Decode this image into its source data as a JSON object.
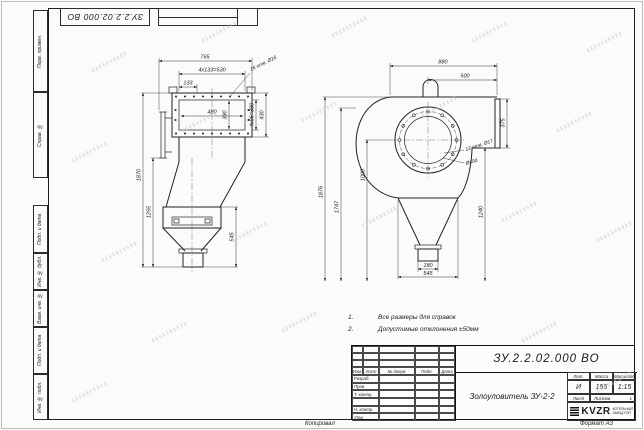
{
  "frame": {
    "stamp_number": "ЗУ.2.2.02.000 ВО",
    "side_labels": [
      "Перв. примен.",
      "Справ. №",
      "Подп. и дата",
      "Инв. № дубл.",
      "Взам. инв. №",
      "Подп. и дата",
      "Инв. № подл."
    ],
    "footer_copy": "Копировал",
    "footer_format": "Формат А3"
  },
  "notes": {
    "n1": "1.",
    "t1": "Все размеры для справок",
    "n2": "2.",
    "t2": "Допустимые отклонения ±50мм"
  },
  "front": {
    "total_width": "765",
    "bolt_pitch_h": "4x133=530",
    "pitch": "133",
    "holes_note": "16 отв. Ø16",
    "inner_width": "480",
    "inner_height": "390",
    "bolt_pitch_v": "4x95=380",
    "flange_height": "430",
    "total_height": "1870",
    "body_height": "1255",
    "hopper_height": "545"
  },
  "side": {
    "total_width": "880",
    "outlet_offset": "500",
    "total_height": "1876",
    "inner_height": "1747",
    "center_height": "1000",
    "flange_height": "375",
    "right_height": "1240",
    "holes_note": "12 отв. Ø17",
    "outlet_dia": "Ø400",
    "outlet_width": "180",
    "hopper_width": "545"
  },
  "title_block": {
    "doc_number": "ЗУ.2.2.02.000 ВО",
    "title": "Золоуловитель ЗУ-2-2",
    "col_izm": "Изм.",
    "col_list": "Лист",
    "col_doc": "№ докум.",
    "col_sign": "Подп.",
    "col_date": "Дата",
    "row_dev": "Разраб.",
    "row_check": "Пров.",
    "row_tcontr": "Т. контр.",
    "row_ncontr": "Н. контр.",
    "row_approve": "Утв.",
    "lit_h": "Лит.",
    "mass_h": "Масса",
    "scale_h": "Масштаб",
    "lit_v": "И",
    "mass_v": "155",
    "scale_v": "1:15",
    "sheet_h": "Лист",
    "sheets_h": "Листов",
    "sheets_v": "1",
    "logo": "KVZR",
    "logo_line1": "КОТЕЛЬНЫЙ",
    "logo_line2": "ЗАВОД РЭП"
  }
}
